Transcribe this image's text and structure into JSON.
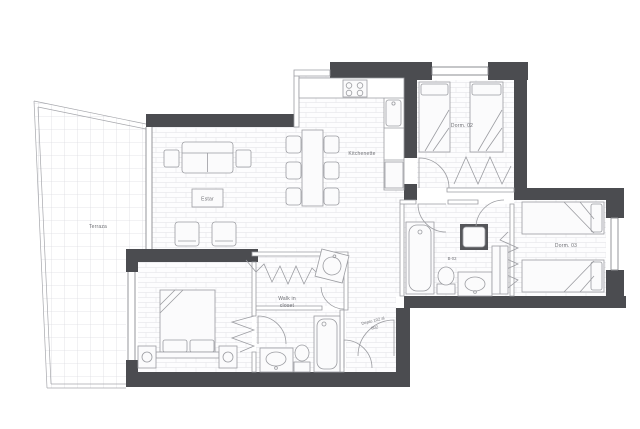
{
  "plan": {
    "type": "apartment-floor-plan",
    "rooms": {
      "terrace": "Terraza",
      "living": "Estar",
      "kitchen": "Kitchenette",
      "bedroom_2": "Dorm. 02",
      "bedroom_3": "Dorm. 03",
      "bathroom_2": "B-02",
      "walk_in_closet": [
        "Walk in",
        "closet"
      ],
      "unit_range": [
        "Depto 102 al",
        "802"
      ]
    },
    "colors": {
      "wall": "#4b4c50",
      "furniture_line": "#9b9ca1",
      "window_line": "#8b8c91",
      "floor_hatch": "#e9e9ed",
      "terrace_grid": "#dcdce1",
      "label_text": "#6e6f74",
      "background": "#ffffff",
      "fixture_dark": "#55565a"
    }
  }
}
